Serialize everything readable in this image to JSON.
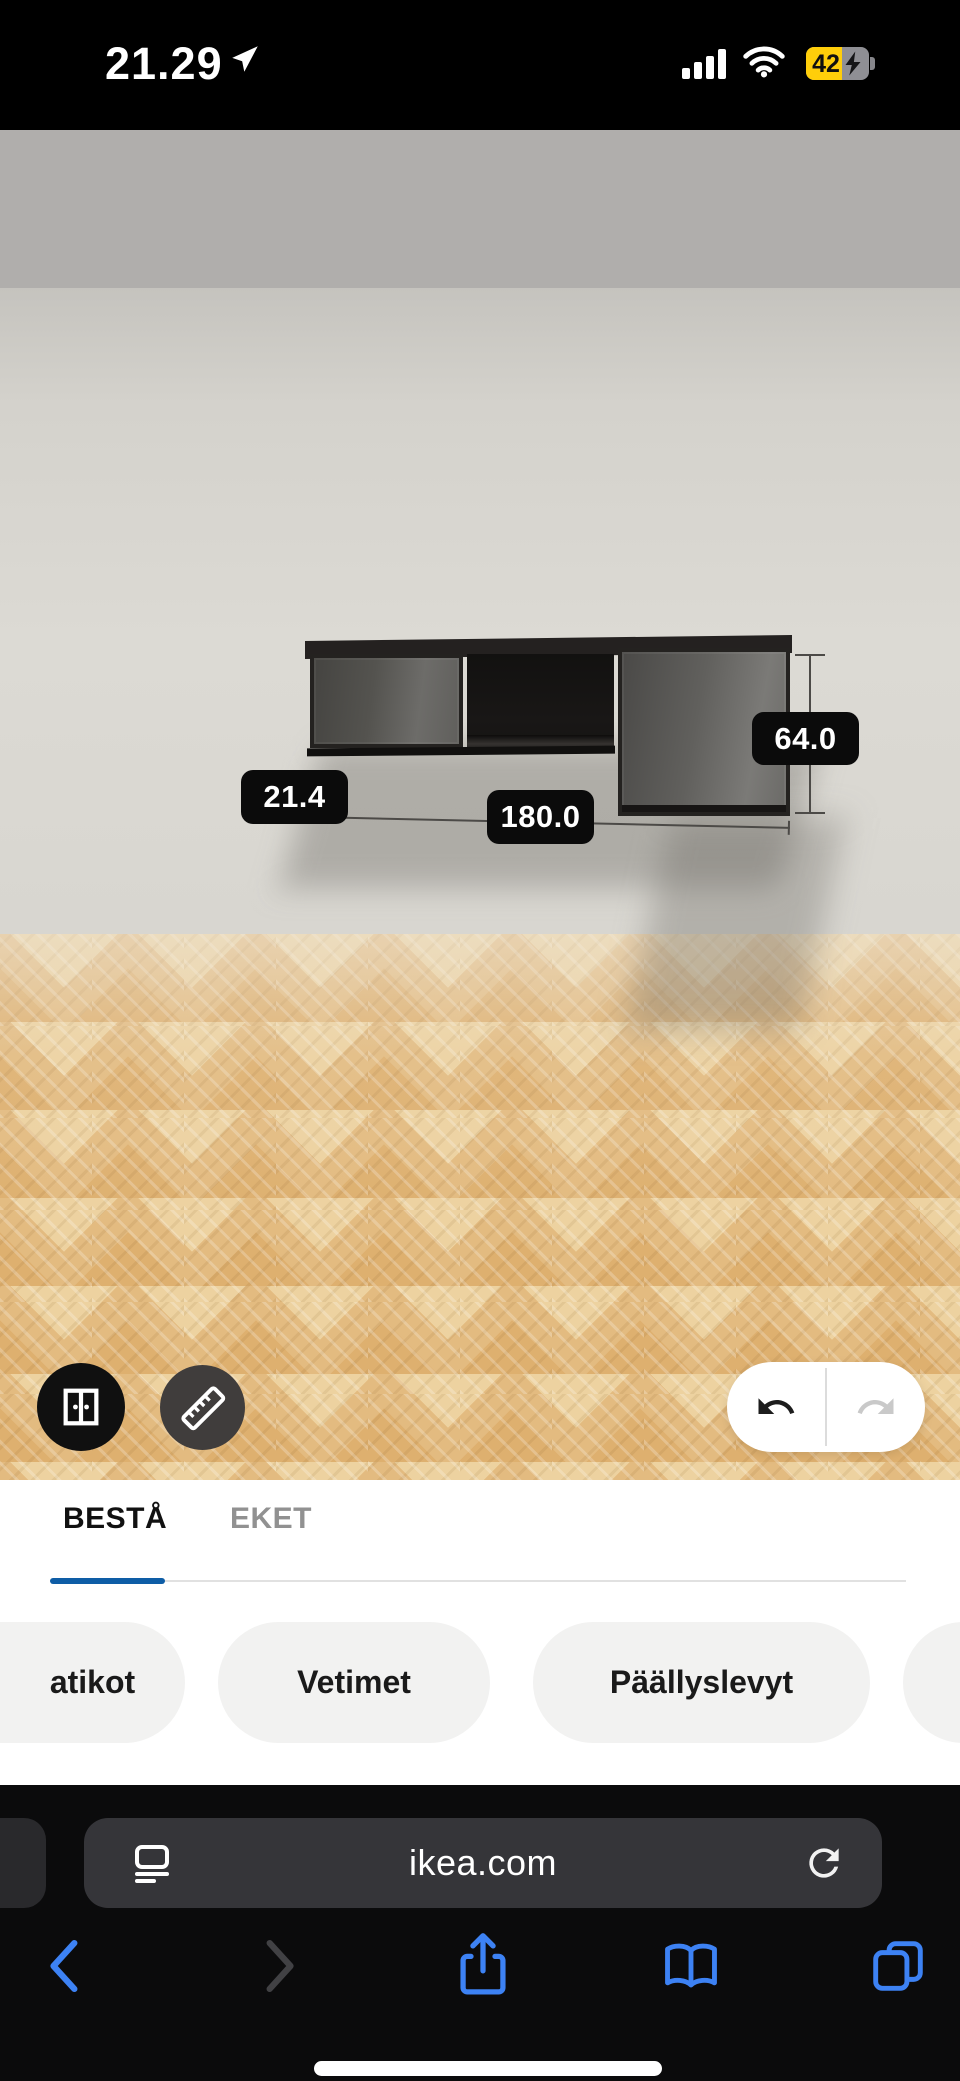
{
  "status_bar": {
    "time": "21.29",
    "battery_percent": "42",
    "icons": [
      "location-arrow-icon",
      "cellular-signal-icon",
      "wifi-icon",
      "battery-charging-icon"
    ]
  },
  "app_header": {
    "menu_icon": "hamburger-menu-icon",
    "item_list_icon": "numbered-list-icon",
    "price_int": "230",
    "price_dec": ",00",
    "currency": "€",
    "next_icon": "arrow-right-icon",
    "accent_color": "#1166a7"
  },
  "scene": {
    "product": "wall cabinet 3D model",
    "dim_width": "180.0",
    "dim_height": "64.0",
    "dim_depth": "21.4",
    "tools": [
      "door-toggle-button",
      "ruler-button",
      "undo-button",
      "redo-button"
    ]
  },
  "tabs": [
    {
      "label": "BESTÅ",
      "active": true
    },
    {
      "label": "EKET",
      "active": false
    }
  ],
  "category_pills": [
    {
      "label": "atikot"
    },
    {
      "label": "Vetimet"
    },
    {
      "label": "Päällyslevyt"
    },
    {
      "label": ""
    }
  ],
  "browser": {
    "url": "ikea.com",
    "toolbar_icons": [
      "back-icon",
      "forward-icon",
      "share-icon",
      "bookmarks-icon",
      "tabs-icon"
    ],
    "accent_color": "#3d82f4"
  },
  "colors": {
    "ikea_blue": "#1166a7",
    "tab_underline": "#0e5da6",
    "battery_yellow": "#ffce0a",
    "ios_blue": "#3d82f4",
    "header_gray": "#b0aeac",
    "floor_wood": "#e3bb80",
    "label_bg": "#0b0b0b"
  }
}
